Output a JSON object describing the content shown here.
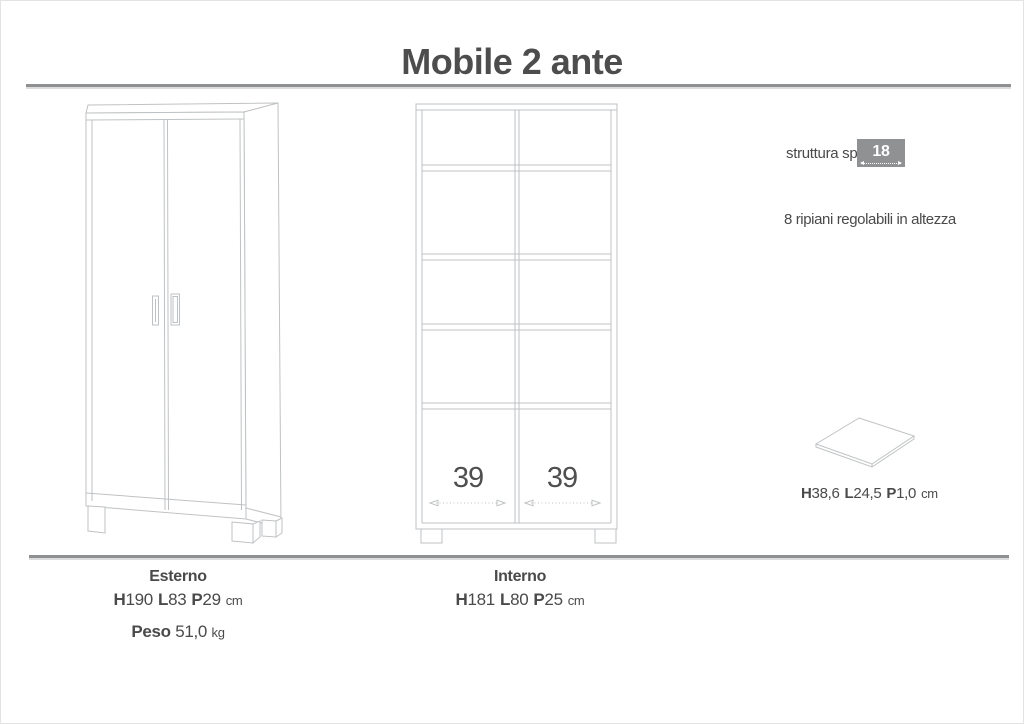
{
  "title": "Mobile 2 ante",
  "colors": {
    "text": "#4a4a4a",
    "drawing_line": "#bfc2c4",
    "thickness_box_bg": "#8f9193",
    "thickness_box_text": "#ffffff",
    "separator": "#8e9092"
  },
  "annotations": {
    "structure_label": "struttura sp.",
    "structure_thickness": "18 mm",
    "shelves_note": "8 ripiani regolabili in altezza"
  },
  "shelf_panel": {
    "dims": [
      {
        "label": "H",
        "value": "38,6"
      },
      {
        "label": "L",
        "value": "24,5"
      },
      {
        "label": "P",
        "value": "1,0"
      }
    ],
    "unit": "cm"
  },
  "interior": {
    "left_width": "39",
    "right_width": "39"
  },
  "specs": {
    "esterno": {
      "label": "Esterno",
      "dims": [
        {
          "label": "H",
          "value": "190"
        },
        {
          "label": "L",
          "value": "83"
        },
        {
          "label": "P",
          "value": "29"
        }
      ],
      "unit": "cm",
      "peso_label": "Peso",
      "peso_value": "51,0",
      "peso_unit": "kg"
    },
    "interno": {
      "label": "Interno",
      "dims": [
        {
          "label": "H",
          "value": "181"
        },
        {
          "label": "L",
          "value": "80"
        },
        {
          "label": "P",
          "value": "25"
        }
      ],
      "unit": "cm"
    }
  },
  "drawings": {
    "exterior_view": "cabinet-exterior-perspective",
    "interior_view": "cabinet-interior-front",
    "shelf_view": "shelf-panel-perspective"
  }
}
